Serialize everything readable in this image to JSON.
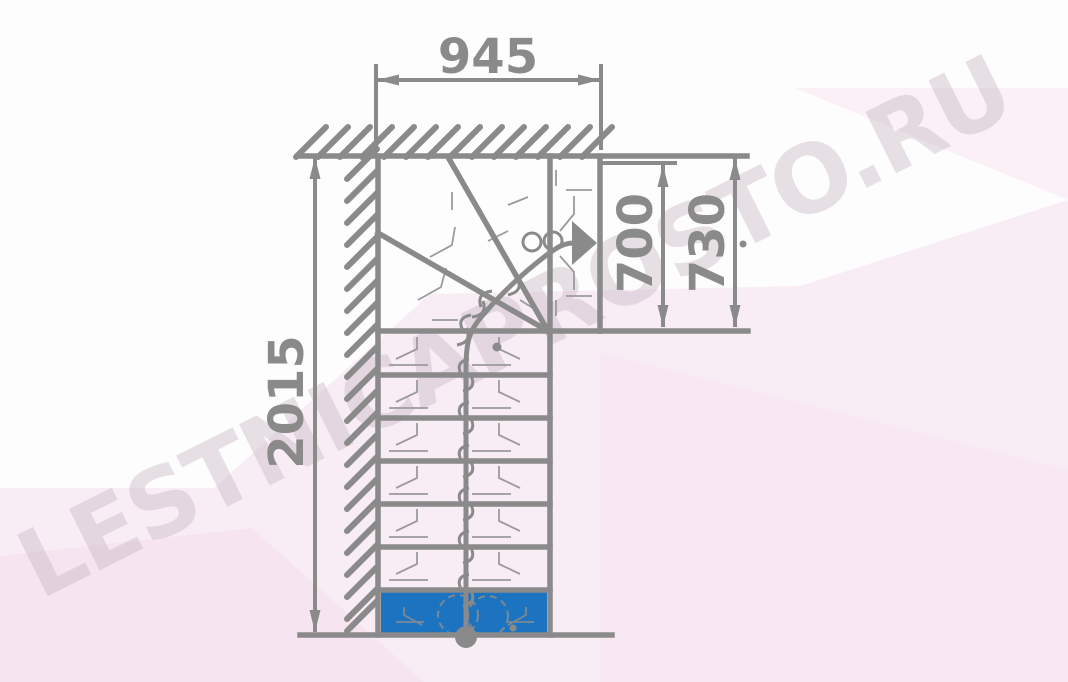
{
  "watermark": {
    "text": "LESTNICAPROSTO.RU"
  },
  "dimensions": {
    "total_width_top": "945",
    "total_length_left": "2015",
    "exit_flight_width": "700",
    "opening_width": "730"
  },
  "stair": {
    "view": "plan",
    "shape": "L-turn with winder steps",
    "straight_steps_visible": 7,
    "winder_steps_visible": 3,
    "first_step_highlighted": true,
    "travel_direction": "up, turning right, exit to the right"
  },
  "colors": {
    "drawing_line": "#8a8a8a",
    "thin_marks": "#9b9b9b",
    "first_step_blue": "#1c74c0",
    "background_pink": "#f9edf5",
    "watermark_gray": "#c1afbe"
  }
}
